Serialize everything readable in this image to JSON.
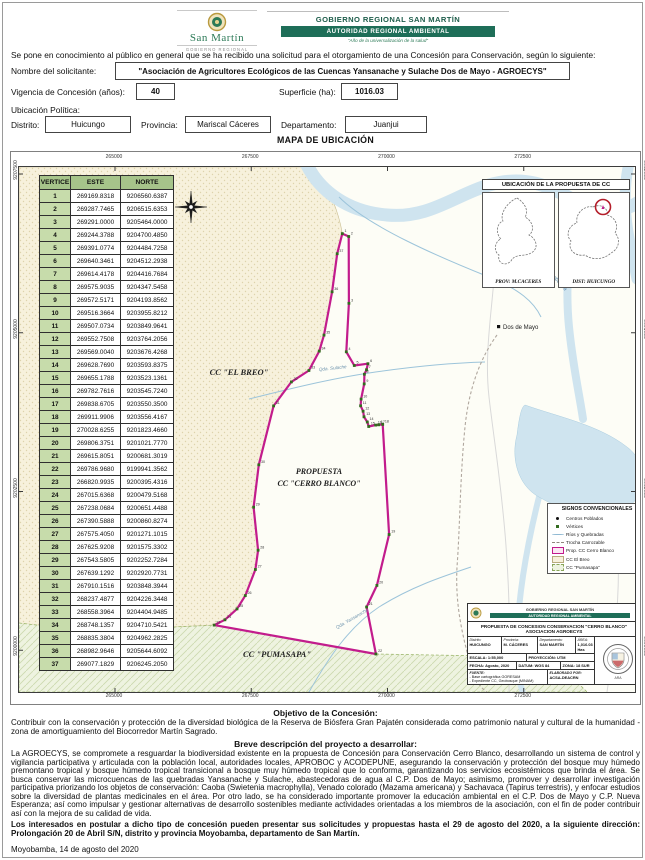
{
  "header": {
    "left_logo": {
      "name": "San Martín",
      "subtitle": "GOBIERNO REGIONAL"
    },
    "right": {
      "line1": "GOBIERNO REGIONAL SAN MARTÍN",
      "banner": "AUTORIDAD REGIONAL AMBIENTAL",
      "tagline": "\"Año de la universalización de la salud\""
    }
  },
  "intro": "Se pone en conocimiento al público en general que se ha recibido una solicitud para el otorgamiento de una Concesión para Conservación, según lo siguiente:",
  "form": {
    "solicitante_label": "Nombre del solicitante:",
    "solicitante_value": "\"Asociación de Agricultores Ecológicos de las Cuencas Yansanache y Sulache Dos de Mayo - AGROECYS\"",
    "vigencia_label": "Vigencia de Concesión (años):",
    "vigencia_value": "40",
    "superficie_label": "Superficie (ha):",
    "superficie_value": "1016.03",
    "ubicacion_label": "Ubicación Política:",
    "distrito_label": "Distrito:",
    "distrito_value": "Huicungo",
    "provincia_label": "Provincia:",
    "provincia_value": "Mariscal Cáceres",
    "departamento_label": "Departamento:",
    "departamento_value": "Juanjui"
  },
  "map": {
    "title": "MAPA DE UBICACIÓN",
    "x_ticks": [
      "265000",
      "267500",
      "270000",
      "272500"
    ],
    "y_ticks": [
      "9207500",
      "9205000",
      "9202500",
      "9200000"
    ],
    "vertex_table": {
      "headers": [
        "VERTICE",
        "ESTE",
        "NORTE"
      ],
      "rows": [
        [
          "1",
          "269169.8318",
          "9206560.6387"
        ],
        [
          "2",
          "269287.7465",
          "9206515.6353"
        ],
        [
          "3",
          "269291.0000",
          "9205464.0000"
        ],
        [
          "4",
          "269244.3788",
          "9204700.4850"
        ],
        [
          "5",
          "269391.0774",
          "9204484.7258"
        ],
        [
          "6",
          "269640.3461",
          "9204512.2938"
        ],
        [
          "7",
          "269614.4178",
          "9204416.7684"
        ],
        [
          "8",
          "269575.9035",
          "9204347.5458"
        ],
        [
          "9",
          "269572.5171",
          "9204193.8562"
        ],
        [
          "10",
          "269516.3664",
          "9203955.8212"
        ],
        [
          "11",
          "269507.0734",
          "9203849.9641"
        ],
        [
          "12",
          "269552.7508",
          "9203764.2056"
        ],
        [
          "13",
          "269569.0040",
          "9203676.4268"
        ],
        [
          "14",
          "269628.7690",
          "9203593.8375"
        ],
        [
          "15",
          "269655.1788",
          "9203523.1361"
        ],
        [
          "16",
          "269782.7616",
          "9203545.7240"
        ],
        [
          "17",
          "269838.6705",
          "9203550.3500"
        ],
        [
          "18",
          "269911.9906",
          "9203556.4167"
        ],
        [
          "19",
          "270028.6255",
          "9201823.4660"
        ],
        [
          "20",
          "269806.3751",
          "9201021.7770"
        ],
        [
          "21",
          "269615.8051",
          "9200681.3019"
        ],
        [
          "22",
          "269786.9680",
          "9199941.3562"
        ],
        [
          "23",
          "266820.9935",
          "9200395.4316"
        ],
        [
          "24",
          "267015.6368",
          "9200479.5168"
        ],
        [
          "25",
          "267238.0684",
          "9200651.4488"
        ],
        [
          "26",
          "267390.5888",
          "9200860.8274"
        ],
        [
          "27",
          "267575.4050",
          "9201271.1015"
        ],
        [
          "28",
          "267625.9208",
          "9201575.3302"
        ],
        [
          "29",
          "267543.5805",
          "9202252.7284"
        ],
        [
          "30",
          "267639.1292",
          "9202920.7731"
        ],
        [
          "31",
          "267910.1516",
          "9203848.3944"
        ],
        [
          "32",
          "268237.4877",
          "9204226.3448"
        ],
        [
          "33",
          "268558.3964",
          "9204404.9485"
        ],
        [
          "34",
          "268748.1357",
          "9204710.5421"
        ],
        [
          "35",
          "268835.3804",
          "9204962.2825"
        ],
        [
          "36",
          "268982.9646",
          "9205644.6092"
        ],
        [
          "37",
          "269077.1829",
          "9206245.2050"
        ]
      ]
    },
    "labels": {
      "breo": "CC \"EL BREO\"",
      "pumasapa": "CC \"PUMASAPA\"",
      "propuesta_line1": "PROPUESTA",
      "propuesta_line2": "CC \"CERRO BLANCO\"",
      "town": "Dos de Mayo",
      "river": "Río Huayabamba",
      "stream1": "Qda. Sulache",
      "stream2": "Qda. Yansanache"
    },
    "inset": {
      "title": "UBICACIÓN DE LA PROPUESTA DE CC",
      "left_caption": "PROV: M.CACERES",
      "right_caption": "DIST: HUICUNGO"
    },
    "legend": {
      "title": "SIGNOS CONVENCIONALES",
      "items": [
        {
          "label": "Centros Poblados",
          "type": "dot"
        },
        {
          "label": "Vértices",
          "type": "vert"
        },
        {
          "label": "Ríos y Quebradas",
          "type": "river"
        },
        {
          "label": "Trocha Carrozable",
          "type": "track"
        },
        {
          "label": "Prop. CC Cerro Blanco",
          "type": "prop"
        },
        {
          "label": "CC El Breo",
          "type": "breo"
        },
        {
          "label": "CC \"Pumasapa\"",
          "type": "puma"
        }
      ]
    },
    "title_block": {
      "org_line1": "GOBIERNO REGIONAL SAN MARTÍN",
      "org_line2": "AUTORIDAD REGIONAL AMBIENTAL",
      "title": "PROPUESTA DE CONCESION CONSERVACION \"CERRO BLANCO\" ASOCIACION AGROECYS",
      "distrito_label": "Distrito:",
      "distrito": "HUICUNGO",
      "provincia_label": "Provincia:",
      "provincia": "M. CÁCERES",
      "departamento_label": "Departamento:",
      "departamento": "SAN MARTÍN",
      "area_label": "ÁREA:",
      "area": "1,016.03 Has",
      "escala": "ESCALA: 1:55,000",
      "proyeccion": "PROYECCIÓN: UTM",
      "fecha": "FECHA: Agosto, 2020",
      "datum": "DATUM: WGS 84",
      "zona": "ZONA: 18 SUR",
      "fuente_label": "FUENTE:",
      "fuente1": "- Base cartográfica GORESAM",
      "fuente2": "- Expediente CC, Geobosque (MINAM)",
      "elaborado_label": "ELABORADO POR:",
      "elaborado": "ACSA-DEACRN"
    }
  },
  "objetivo": {
    "heading": "Objetivo de la Concesión:",
    "body": "Contribuir con la conservación y protección de la diversidad biológica de la Reserva de Biósfera Gran Pajatén considerada como patrimonio natural y cultural de la humanidad - zona de amortiguamiento del Biocorredor Martín Sagrado."
  },
  "descripcion": {
    "heading": "Breve descripción del proyecto a desarrollar:",
    "body": "La AGROECYS, se compromete a resguardar la biodiversidad existente en la propuesta de Concesión para Conservación Cerro Blanco, desarrollando un sistema de control y vigilancia participativa y articulada con la población local, autoridades locales, APROBOC y ACODEPUNE, asegurando la conservación y protección del bosque muy húmedo premontano tropical y bosque húmedo tropical transicional a bosque muy húmedo tropical que lo conforma, garantizando los servicios ecosistémicos que brinda el área. Se busca conservar las microcuencas de las quebradas Yansanache y Sulache, abastecedoras de agua al C.P. Dos de Mayo; asimismo, promover y desarrollar investigación participativa priorizando los objetos de conservación: Caoba (Swietenia macrophylla), Venado colorado (Mazama americana) y Sachavaca (Tapirus terrestris), y enfocar estudios sobre la diversidad de plantas medicinales en el área. Por otro lado, se ha considerado importante promover la educación ambiental en el C.P. Dos de Mayo y C.P. Nueva Esperanza; así como impulsar y gestionar alternativas de desarrollo sostenibles mediante actividades orientadas a los miembros de la asociación, con el fin de poder contribuir así con la mejora de su calidad de vida."
  },
  "aviso": "Los interesados en postular a dicho tipo de concesión pueden presentar sus solicitudes y propuestas hasta el 29 de agosto del 2020, a la siguiente dirección: Prolongación 20 de Abril S/N, distrito y provincia Moyobamba, departamento de San Martín.",
  "fecha_doc": "Moyobamba, 14 de agosto del 2020",
  "colors": {
    "banner_green": "#1e6e58",
    "polygon_magenta": "#c21c8c",
    "table_header_green": "#a6c48a",
    "vertex_cell_green": "#c7dcab",
    "river_blue": "#cfe4ef",
    "breo_beige": "#f7f1dc",
    "puma_green": "#eef3e0"
  },
  "geo": {
    "x0": 96,
    "e0": 265000,
    "sx": 0.0545,
    "y0": 7,
    "n0": 9207500,
    "sy": 0.0635
  }
}
